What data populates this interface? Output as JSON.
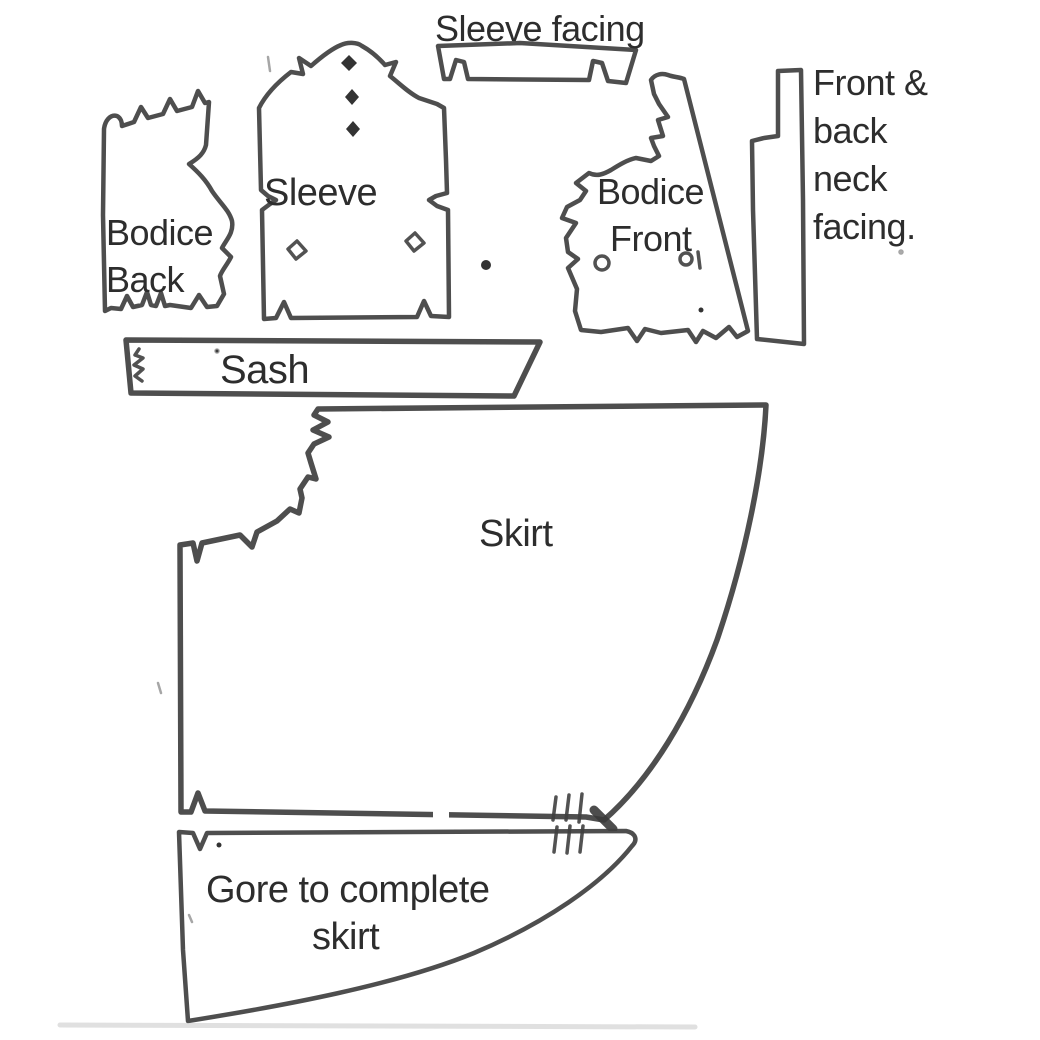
{
  "diagram": {
    "type": "sewing-pattern-cutting-layout",
    "background_color": "#ffffff",
    "ink_color": "#3f3f3f",
    "text_color": "#2d2d2d"
  },
  "pieces": {
    "sleeve_facing": {
      "label": "Sleeve facing"
    },
    "bodice_back": {
      "label_lines": [
        "Bodice",
        "Back"
      ]
    },
    "sleeve": {
      "label": "Sleeve"
    },
    "bodice_front": {
      "label_lines": [
        "Bodice",
        "Front"
      ]
    },
    "neck_facing": {
      "label_lines": [
        "Front &",
        "back",
        "neck",
        "facing."
      ]
    },
    "sash": {
      "label": "Sash"
    },
    "skirt": {
      "label": "Skirt"
    },
    "gore": {
      "label_lines": [
        "Gore to complete",
        "skirt"
      ]
    }
  }
}
